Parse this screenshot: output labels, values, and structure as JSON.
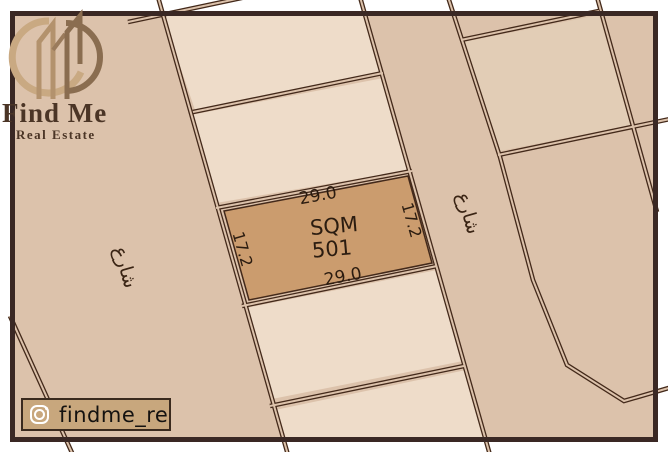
{
  "brand": {
    "name": "Find Me",
    "tagline": "Real Estate",
    "logo_icon": "buildings-circle-logo"
  },
  "social": {
    "platform_icon": "instagram-icon",
    "handle": "findme_re"
  },
  "plot": {
    "area_label": "SQM",
    "area_value": "501",
    "dim_top": "29.0",
    "dim_bottom": "29.0",
    "dim_left": "17.2",
    "dim_right": "17.2"
  },
  "streets": {
    "left_label": "شارع",
    "right_label": "شارع"
  },
  "colors": {
    "page_bg": "#ffffff",
    "map_bg": "#dcc2ab",
    "parcel_fill": "#eedcc9",
    "parcel_fill_right": "#e2cdb6",
    "highlight_fill": "#cb9c6e",
    "road_line": "#43291a",
    "frame": "#3a2824",
    "label_text": "#2b1c10",
    "logo_text": "#4b3526",
    "badge_bg": "#c8a77d"
  }
}
